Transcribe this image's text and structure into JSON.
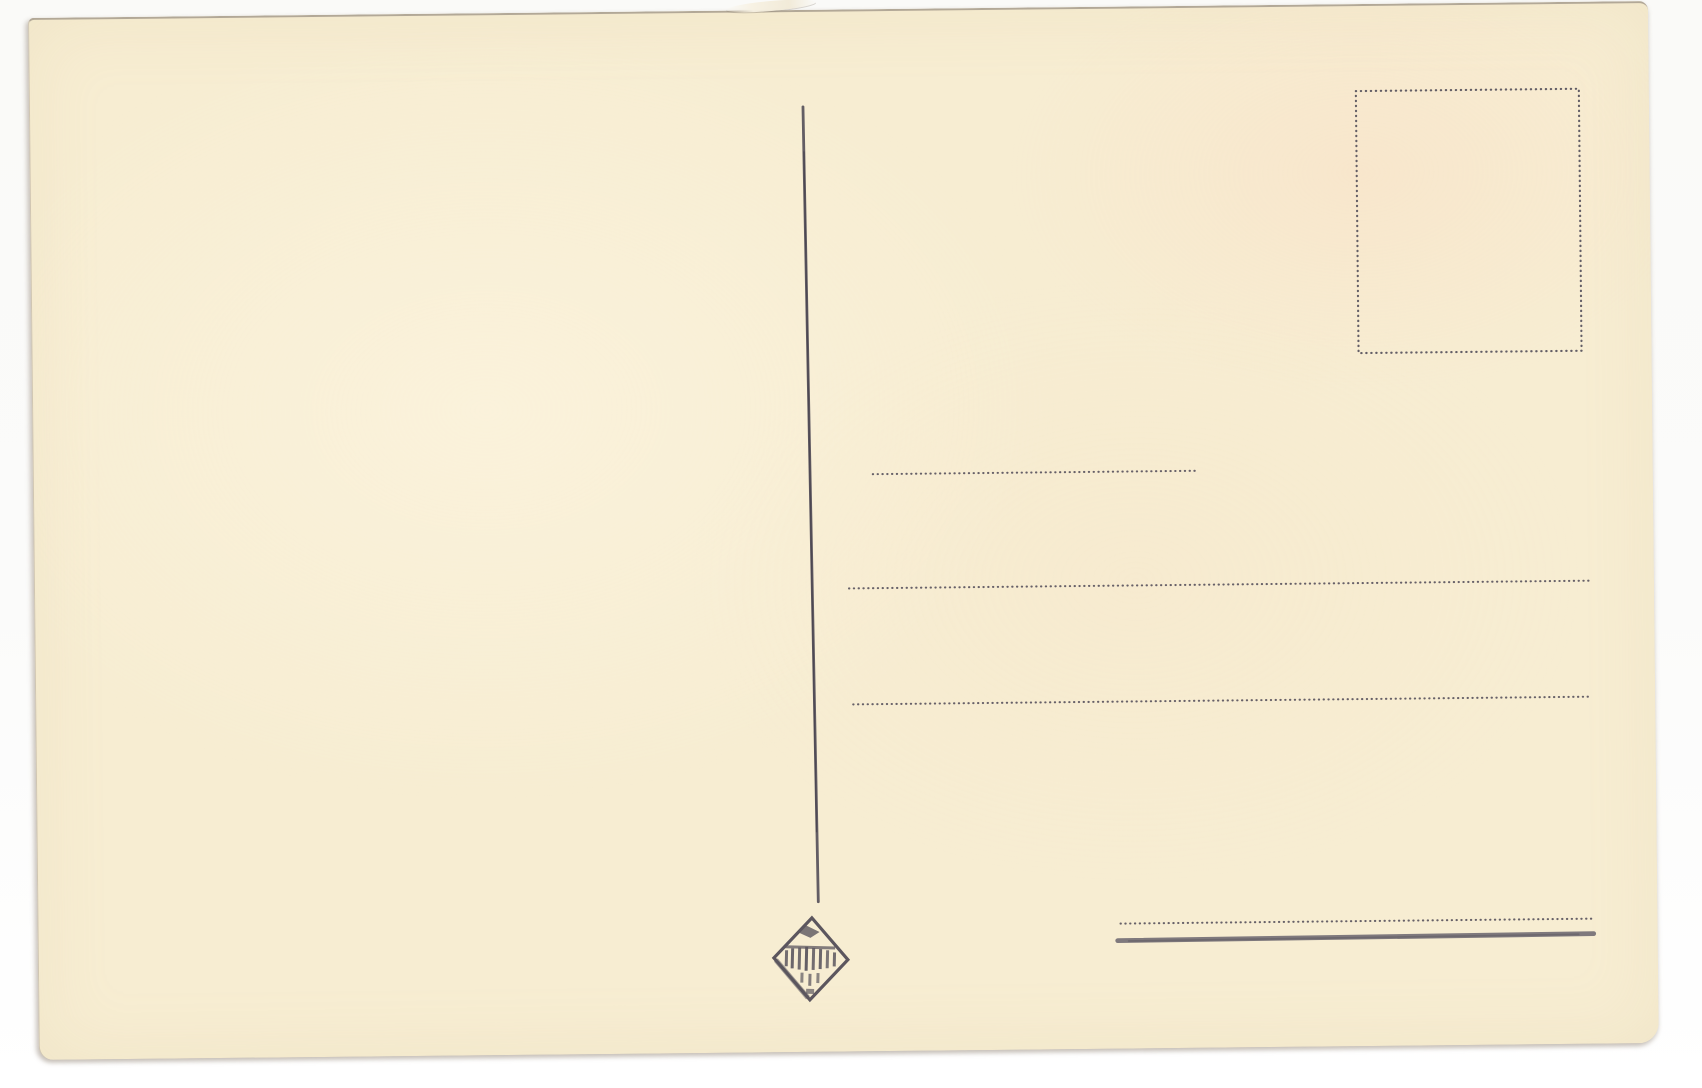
{
  "meta": {
    "description": "Scanned back of a blank vintage postcard on a white scanner background",
    "visible_text": []
  },
  "colors": {
    "scan_background": "#fbfbfa",
    "card_paper": "#f7edd2",
    "ink": "#4f4a55",
    "dots": "#56515c",
    "rule": "#6f6a72",
    "edge_shadow": "#9a9186"
  },
  "postcard": {
    "stamp_box": {
      "border_style": "dotted outline, empty"
    },
    "divider_line": {
      "style": "inked vertical line, slightly slanted, blank message side at left"
    },
    "address_lines": [
      {
        "style": "dotted",
        "length": "short"
      },
      {
        "style": "dotted",
        "length": "long"
      },
      {
        "style": "dotted",
        "length": "long"
      },
      {
        "style": "dotted",
        "length": "medium"
      }
    ],
    "bottom_rule": {
      "style": "solid gray line under last dotted line"
    },
    "publisher_logo": {
      "icon": "diamond-publisher-mark-icon",
      "text_legible": false
    }
  }
}
